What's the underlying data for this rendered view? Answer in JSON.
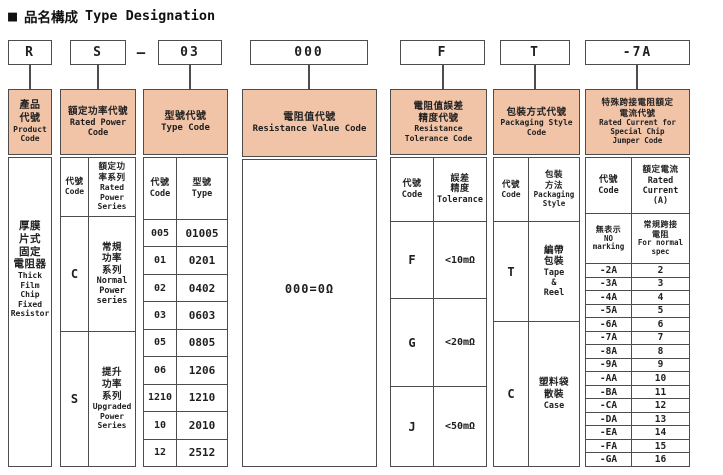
{
  "title": {
    "square": "■",
    "zh": "品名構成",
    "en": "Type Designation"
  },
  "dash": "–",
  "code_boxes": [
    "R",
    "S",
    "03",
    "000",
    "F",
    "T",
    "-7A"
  ],
  "colors": {
    "header_bg": "#f1c3a7",
    "border": "#4d4d4d"
  },
  "columns": {
    "product": {
      "header_zh": "產品\n代號",
      "header_en": "Product\nCode",
      "content_zh": "厚膜\n片式\n固定\n電阻器",
      "content_en": "Thick\nFilm\nChip\nFixed\nResistor"
    },
    "power": {
      "header_zh": "額定功率代號",
      "header_en": "Rated Power\nCode",
      "sub_code_zh": "代號",
      "sub_code_en": "Code",
      "sub_series_zh": "額定功\n率系列",
      "sub_series_en": "Rated\nPower\nSeries",
      "rows": [
        {
          "code": "C",
          "zh": "常規\n功率\n系列",
          "en": "Normal\nPower\nseries"
        },
        {
          "code": "S",
          "zh": "提升\n功率\n系列",
          "en": "Upgraded\nPower\nSeries"
        }
      ]
    },
    "type": {
      "header_zh": "型號代號",
      "header_en": "Type Code",
      "sub_code_zh": "代號",
      "sub_code_en": "Code",
      "sub_type_zh": "型號",
      "sub_type_en": "Type",
      "rows": [
        {
          "code": "005",
          "type": "01005"
        },
        {
          "code": "01",
          "type": "0201"
        },
        {
          "code": "02",
          "type": "0402"
        },
        {
          "code": "03",
          "type": "0603"
        },
        {
          "code": "05",
          "type": "0805"
        },
        {
          "code": "06",
          "type": "1206"
        },
        {
          "code": "1210",
          "type": "1210"
        },
        {
          "code": "10",
          "type": "2010"
        },
        {
          "code": "12",
          "type": "2512"
        }
      ]
    },
    "resistance": {
      "header_zh": "電阻值代號",
      "header_en": "Resistance Value Code",
      "content": "000=0Ω"
    },
    "tolerance": {
      "header_zh": "電阻值誤差\n精度代號",
      "header_en": "Resistance\nTolerance Code",
      "sub_code_zh": "代號",
      "sub_code_en": "Code",
      "sub_tol_zh": "誤差\n精度",
      "sub_tol_en": "Tolerance",
      "rows": [
        {
          "code": "F",
          "value": "<10mΩ"
        },
        {
          "code": "G",
          "value": "<20mΩ"
        },
        {
          "code": "J",
          "value": "<50mΩ"
        }
      ]
    },
    "packaging": {
      "header_zh": "包裝方式代號",
      "header_en": "Packaging Style\nCode",
      "sub_code_zh": "代號",
      "sub_code_en": "Code",
      "sub_style_zh": "包裝\n方法",
      "sub_style_en": "Packaging\nStyle",
      "rows": [
        {
          "code": "T",
          "zh": "編帶\n包裝",
          "en": "Tape\n&\nReel"
        },
        {
          "code": "C",
          "zh": "塑料袋\n散裝",
          "en": "Case"
        }
      ]
    },
    "jumper": {
      "header_zh": "特殊跨接電阻額定\n電流代號",
      "header_en": "Rated Current for\nSpecial Chip\nJumper Code",
      "sub_code_zh": "代號",
      "sub_code_en": "Code",
      "sub_current_zh": "額定電流",
      "sub_current_en": "Rated\nCurrent\n(A)",
      "no_marking_zh": "無表示",
      "no_marking_en": "NO\nmarking",
      "normal_spec_zh": "常規跨接\n電阻",
      "normal_spec_en": "For normal\nspec",
      "rows": [
        {
          "code": "-2A",
          "amp": "2"
        },
        {
          "code": "-3A",
          "amp": "3"
        },
        {
          "code": "-4A",
          "amp": "4"
        },
        {
          "code": "-5A",
          "amp": "5"
        },
        {
          "code": "-6A",
          "amp": "6"
        },
        {
          "code": "-7A",
          "amp": "7"
        },
        {
          "code": "-8A",
          "amp": "8"
        },
        {
          "code": "-9A",
          "amp": "9"
        },
        {
          "code": "-AA",
          "amp": "10"
        },
        {
          "code": "-BA",
          "amp": "11"
        },
        {
          "code": "-CA",
          "amp": "12"
        },
        {
          "code": "-DA",
          "amp": "13"
        },
        {
          "code": "-EA",
          "amp": "14"
        },
        {
          "code": "-FA",
          "amp": "15"
        },
        {
          "code": "-GA",
          "amp": "16"
        }
      ]
    }
  }
}
